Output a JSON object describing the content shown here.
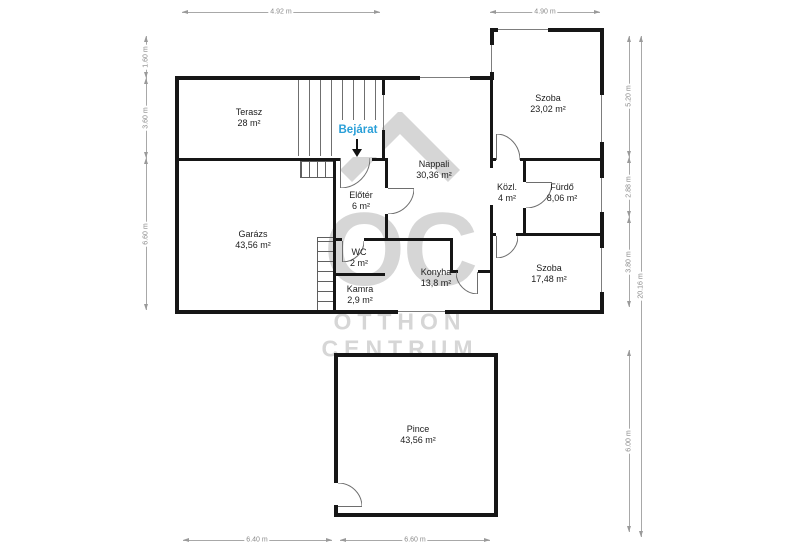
{
  "watermark": {
    "logo": "OC",
    "line1": "OTTHON",
    "line2": "CENTRUM"
  },
  "entrance": {
    "label": "Bejárat"
  },
  "rooms": [
    {
      "name": "Terasz",
      "area": "28 m²"
    },
    {
      "name": "Garázs",
      "area": "43,56 m²"
    },
    {
      "name": "Nappali",
      "area": "30,36 m²"
    },
    {
      "name": "Előtér",
      "area": "6 m²"
    },
    {
      "name": "WC",
      "area": "2 m²"
    },
    {
      "name": "Kamra",
      "area": "2,9 m²"
    },
    {
      "name": "Konyha",
      "area": "13,8 m²"
    },
    {
      "name": "Szoba",
      "area": "23,02 m²"
    },
    {
      "name": "Közl.",
      "area": "4 m²"
    },
    {
      "name": "Fürdő",
      "area": "8,06 m²"
    },
    {
      "name": "Szoba",
      "area": "17,48 m²"
    },
    {
      "name": "Pince",
      "area": "43,56 m²"
    }
  ],
  "dimensions": {
    "top_left": "4.92 m",
    "top_right": "4.90 m",
    "left_top": "1.60 m",
    "left_mid": "3.60 m",
    "left_bottom": "6.60 m",
    "right_top": "5.20 m",
    "right_mid": "2.88 m",
    "right_bottom": "3.80 m",
    "right_lower": "6.00 m",
    "right_total": "20.16 m",
    "bottom_left": "6.40 m",
    "bottom_right": "6.60 m"
  },
  "colors": {
    "wall": "#161616",
    "entrance_accent": "#2a9fd8",
    "dimension": "#8a8a8a",
    "watermark": "#d6d6d6"
  }
}
